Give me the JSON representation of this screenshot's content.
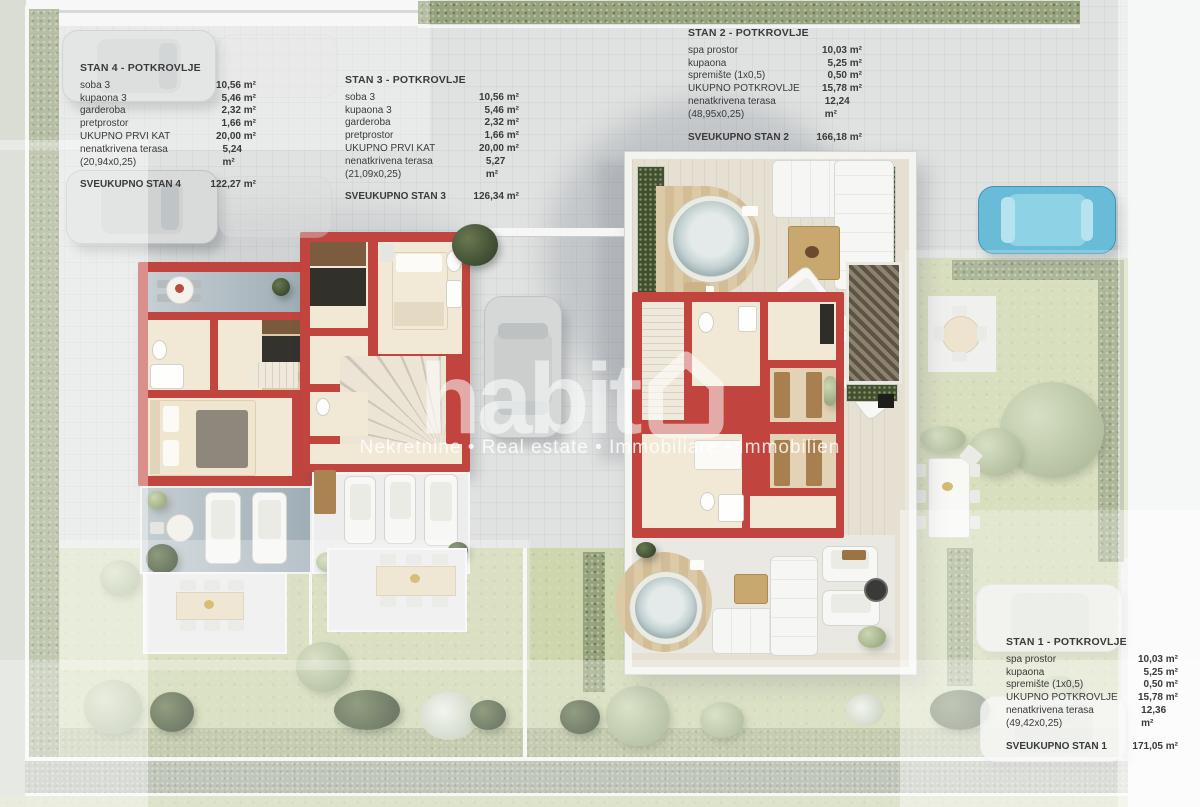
{
  "watermark": {
    "brand": "habita",
    "brand_prefix": "habit",
    "house_icon": "house-icon",
    "tagline": "Nekretnine • Real estate • Immobiliare • Immobilien"
  },
  "units": [
    {
      "id": "stan-4",
      "title": "STAN 4 - POTKROVLJE",
      "rows": [
        {
          "label": "soba 3",
          "value": "10,56 m²"
        },
        {
          "label": "kupaona 3",
          "value": "5,46 m²"
        },
        {
          "label": "garderoba",
          "value": "2,32 m²"
        },
        {
          "label": "pretprostor",
          "value": "1,66 m²"
        },
        {
          "label": "UKUPNO PRVI KAT",
          "value": "20,00 m²"
        },
        {
          "label": "nenatkrivena terasa  (20,94x0,25)",
          "value": "5,24 m²"
        }
      ],
      "total": {
        "label": "SVEUKUPNO STAN 4",
        "value": "122,27 m²"
      }
    },
    {
      "id": "stan-3",
      "title": "STAN 3 - POTKROVLJE",
      "rows": [
        {
          "label": "soba 3",
          "value": "10,56 m²"
        },
        {
          "label": "kupaona 3",
          "value": "5,46 m²"
        },
        {
          "label": "garderoba",
          "value": "2,32 m²"
        },
        {
          "label": "pretprostor",
          "value": "1,66 m²"
        },
        {
          "label": "UKUPNO PRVI KAT",
          "value": "20,00 m²"
        },
        {
          "label": "nenatkrivena terasa  (21,09x0,25)",
          "value": "5,27 m²"
        }
      ],
      "total": {
        "label": "SVEUKUPNO STAN 3",
        "value": "126,34 m²"
      }
    },
    {
      "id": "stan-2",
      "title": "STAN 2 - POTKROVLJE",
      "rows": [
        {
          "label": "spa prostor",
          "value": "10,03 m²"
        },
        {
          "label": "kupaona",
          "value": "5,25 m²"
        },
        {
          "label": "spremište (1x0,5)",
          "value": "0,50 m²"
        },
        {
          "label": "UKUPNO POTKROVLJE",
          "value": "15,78 m²"
        },
        {
          "label": "nenatkrivena terasa  (48,95x0,25)",
          "value": "12,24 m²"
        }
      ],
      "total": {
        "label": "SVEUKUPNO STAN 2",
        "value": "166,18 m²"
      }
    },
    {
      "id": "stan-1",
      "title": "STAN 1 - POTKROVLJE",
      "rows": [
        {
          "label": "spa prostor",
          "value": "10,03 m²"
        },
        {
          "label": "kupaona",
          "value": "5,25 m²"
        },
        {
          "label": "spremište (1x0,5)",
          "value": "0,50 m²"
        },
        {
          "label": "UKUPNO POTKROVLJE",
          "value": "15,78 m²"
        },
        {
          "label": "nenatkrivena terasa  (49,42x0,25)",
          "value": "12,36 m²"
        }
      ],
      "total": {
        "label": "SVEUKUPNO STAN 1",
        "value": "171,05 m²"
      }
    }
  ],
  "palette": {
    "wall_red": "#c1453e",
    "floor_cream": "#f2e8d6",
    "lawn_green": "#ced6ad",
    "hedge_green": "#97a37c",
    "pavement_gray": "#e0e2e1",
    "deck_wood": "#d7c29c",
    "car_blue": "#68bcd8",
    "text_dark": "#3a3a3a",
    "watermark_white": "rgba(255,255,255,0.55)"
  }
}
